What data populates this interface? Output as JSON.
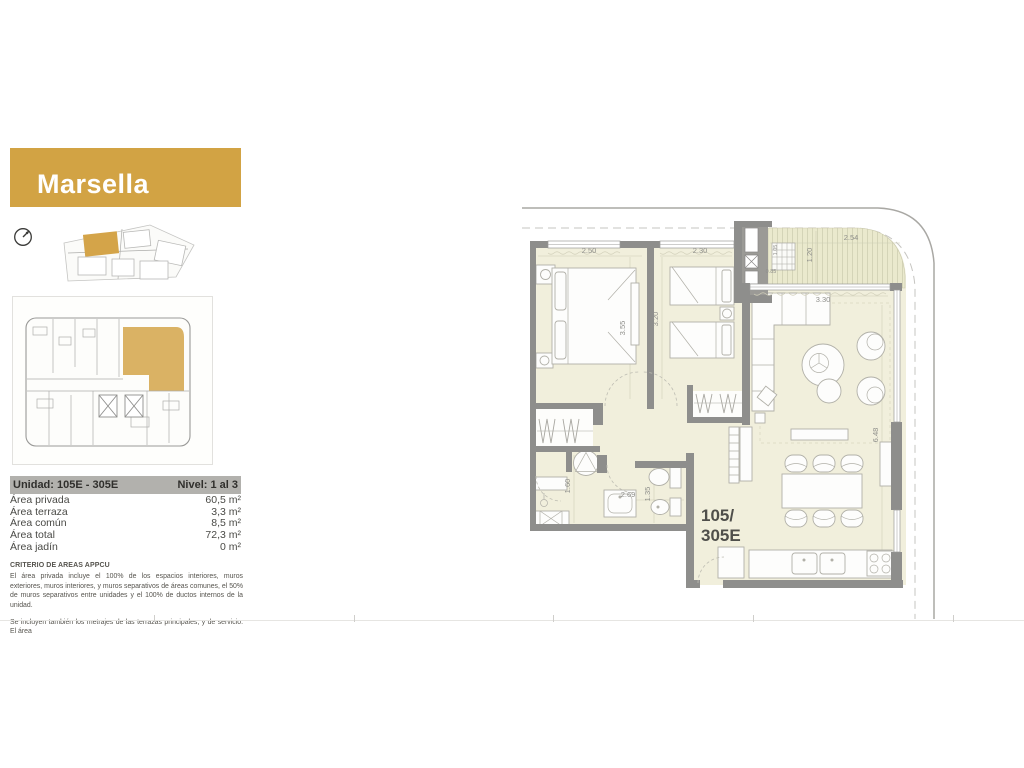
{
  "banner": {
    "title": "Marsella"
  },
  "colors": {
    "accent": "#d2a344",
    "wall": "#8e8e8c",
    "floor": "#f1efdc",
    "terrace": "#eae9cd"
  },
  "unit_info": {
    "unidad": "Unidad: 105E - 305E",
    "nivel": "Nivel: 1  al  3",
    "rows": [
      {
        "label": "Área privada",
        "value": "60,5 m²"
      },
      {
        "label": "Área terraza",
        "value": "3,3 m²"
      },
      {
        "label": "Área común",
        "value": "8,5 m²"
      },
      {
        "label": "Área total",
        "value": "72,3 m²"
      },
      {
        "label": "Área jadín",
        "value": "0 m²"
      }
    ]
  },
  "criteria": {
    "heading": "CRITERIO DE AREAS APPCU",
    "body": "El área privada incluye el 100% de los espacios interiores, muros exteriores, muros interiores, y muros separativos de áreas comunes, el 50% de muros separativos entre unidades y el 100% de ductos internos de la unidad.",
    "footnote": "Se incluyen también los metrajes de las terrazas principales, y de servicio. El área"
  },
  "floor_plan": {
    "unit_label_line1": "105/",
    "unit_label_line2": "305E",
    "dims": {
      "bedroom1_width": "2.50",
      "bedroom1_depth": "3.55",
      "bedroom2_width": "2.30",
      "bedroom2_depth": "3.20",
      "terrace_width": "2.54",
      "terrace_depth": "1.20",
      "duct_width": "1.05",
      "duct_depth": "0.85",
      "living_width": "3.30",
      "living_depth": "6.48",
      "laundry_depth": "1.60",
      "hall_width": "2.69",
      "bath_width": "1.35"
    }
  }
}
